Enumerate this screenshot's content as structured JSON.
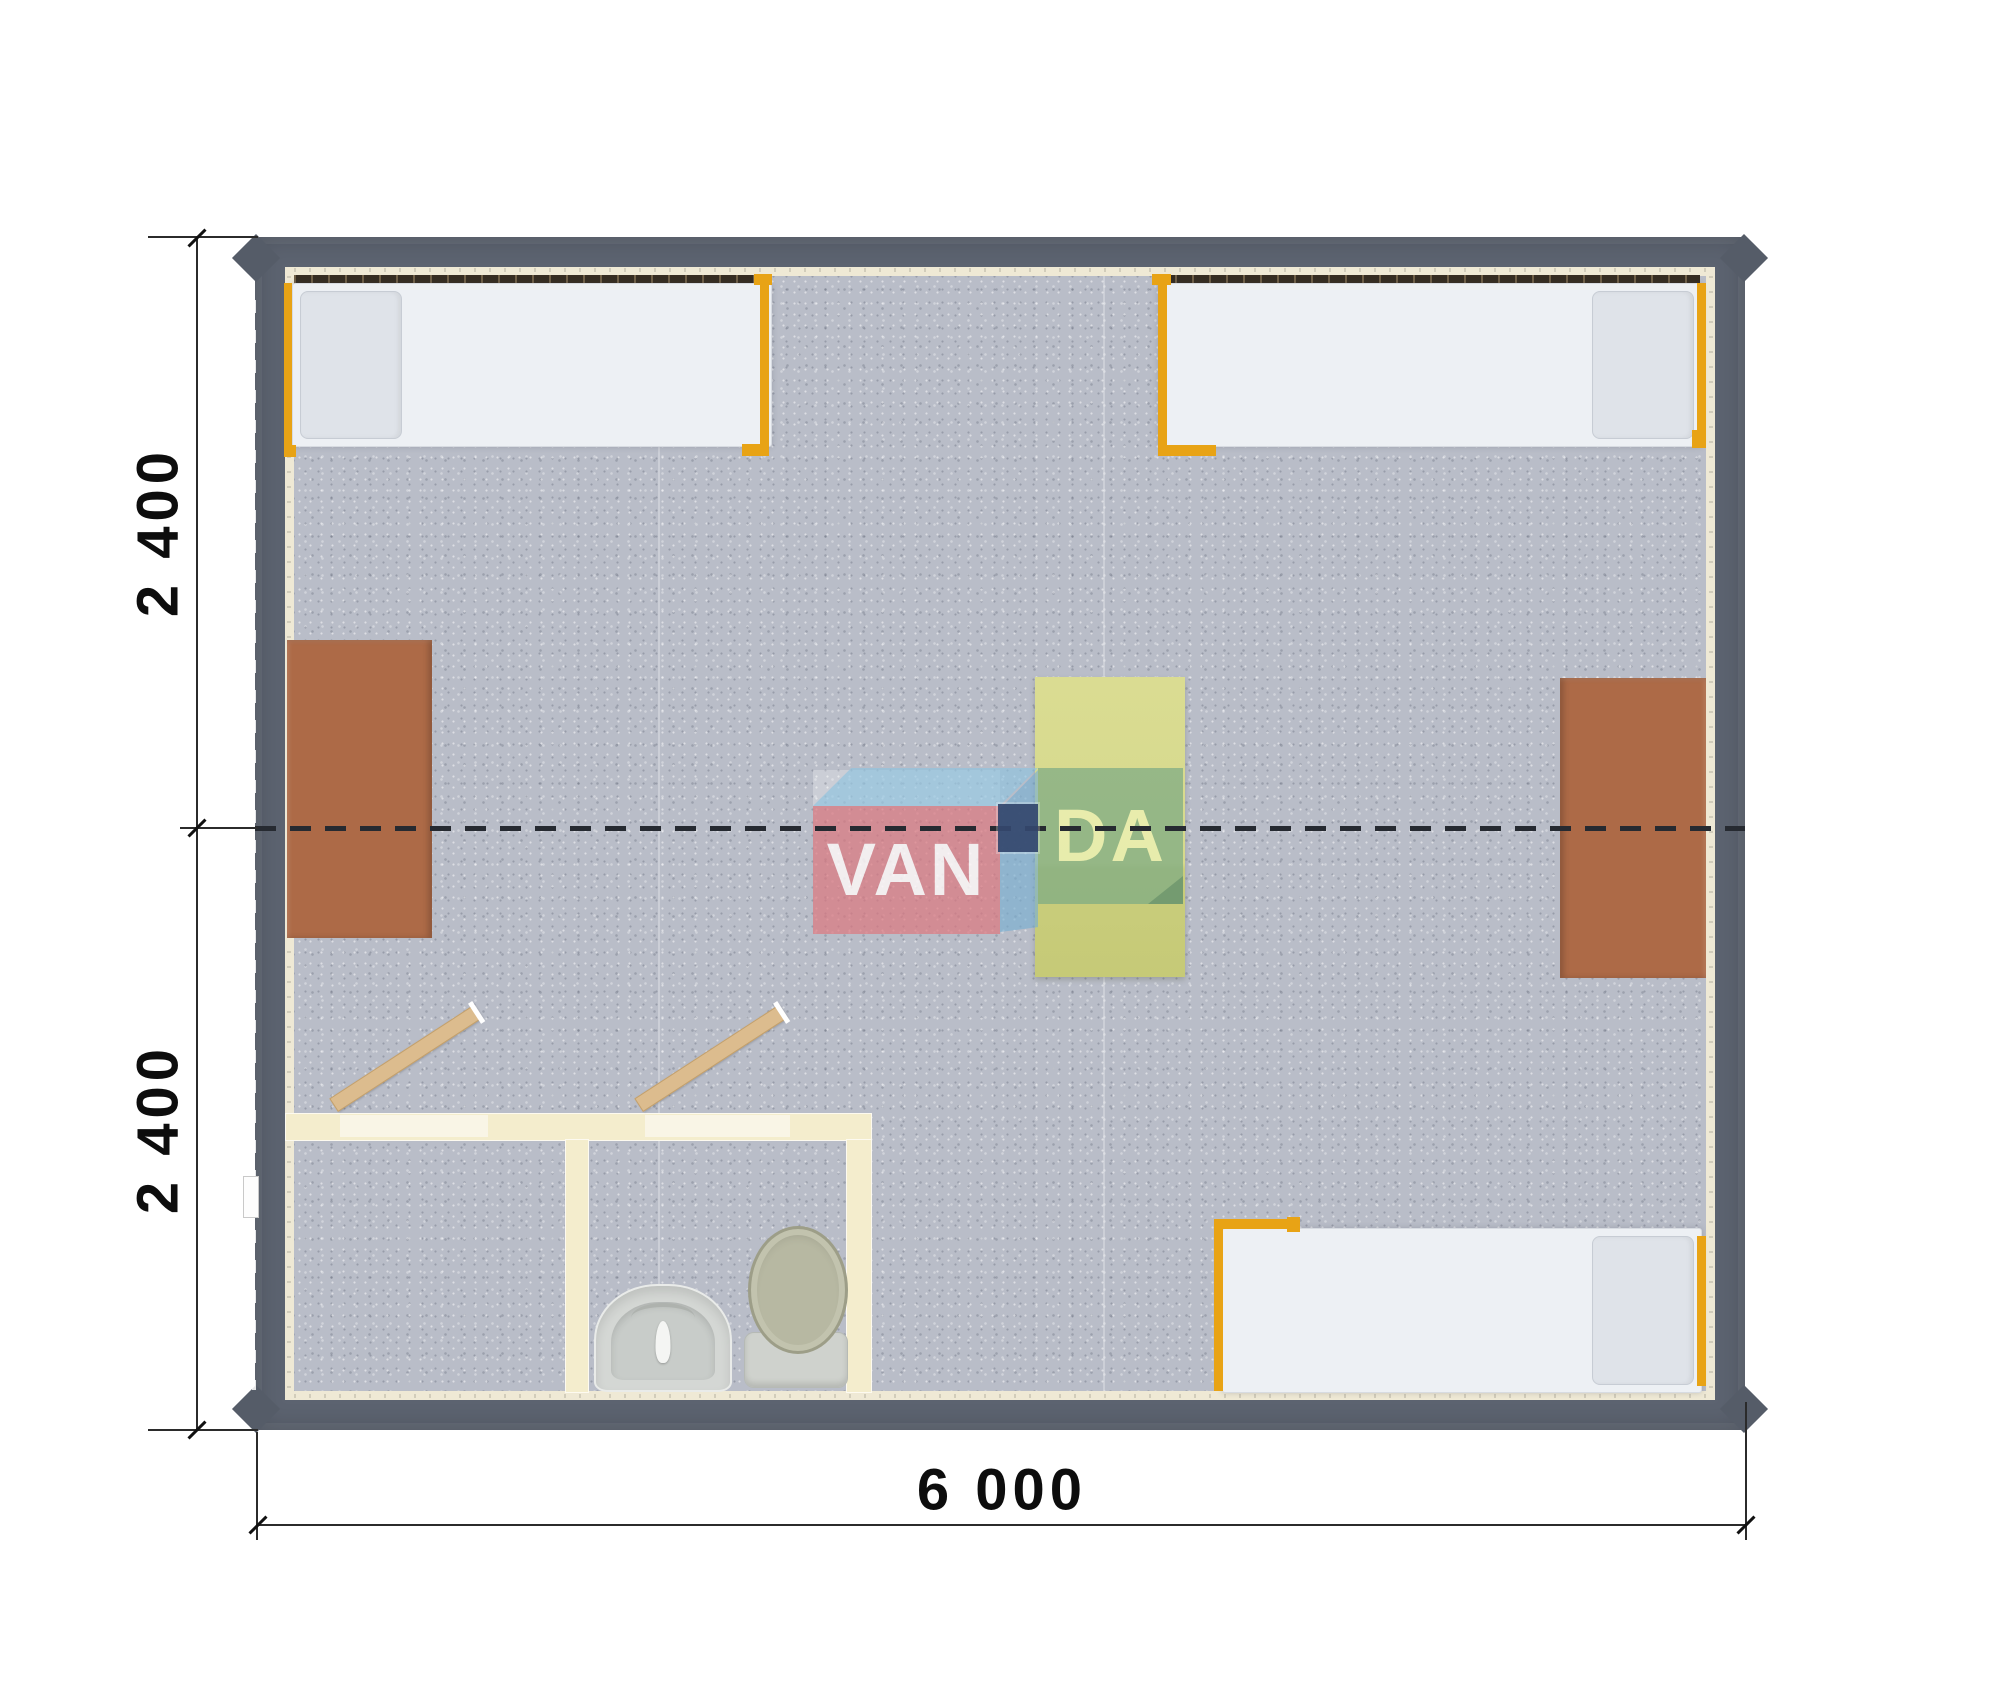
{
  "drawing": {
    "type": "floor-plan-top-view",
    "subject": "modular cabin with four beds, three desks and sanitary block"
  },
  "dimensions": {
    "left_top": "2 400",
    "left_bottom": "2 400",
    "bottom_width": "6 000"
  },
  "logo": {
    "name": "VANDA",
    "text_left": "VAN",
    "text_right": "DA"
  },
  "colors": {
    "wall": "#5c6370",
    "floor_carpet": "#b9bdc8",
    "wall_lining": "#efe9d5",
    "window_strip": "#352c21",
    "bed_mattress": "#edf0f4",
    "bed_pillow": "#dfe3e9",
    "bed_frame_orange": "#e8a315",
    "desk_brown": "#ad6a47",
    "table_yellow": "#d6d98c",
    "bathroom_wall": "#f4edcd",
    "door_wood": "#dcbc8e",
    "logo_red": "#dd767e",
    "logo_blue": "#8bc4e3",
    "logo_green": "#7dab84",
    "logo_navy": "#344870",
    "junction_dash": "#262a31",
    "dimension_ink": "#111111"
  },
  "objects": {
    "beds": [
      "single-bed-top-left",
      "single-bed-top-right",
      "single-bed-bottom-right"
    ],
    "desks": [
      "desk-left-wall",
      "desk-right-wall",
      "table-center"
    ],
    "sanitary": [
      "shower-room",
      "wc-room",
      "washbasin",
      "toilet"
    ],
    "doors": [
      "bath-door-left-open",
      "bath-door-right-open",
      "entrance-door-left-wall"
    ],
    "markers": [
      "module-junction-dashed-line",
      "junction-connector",
      "corner-posts"
    ]
  }
}
